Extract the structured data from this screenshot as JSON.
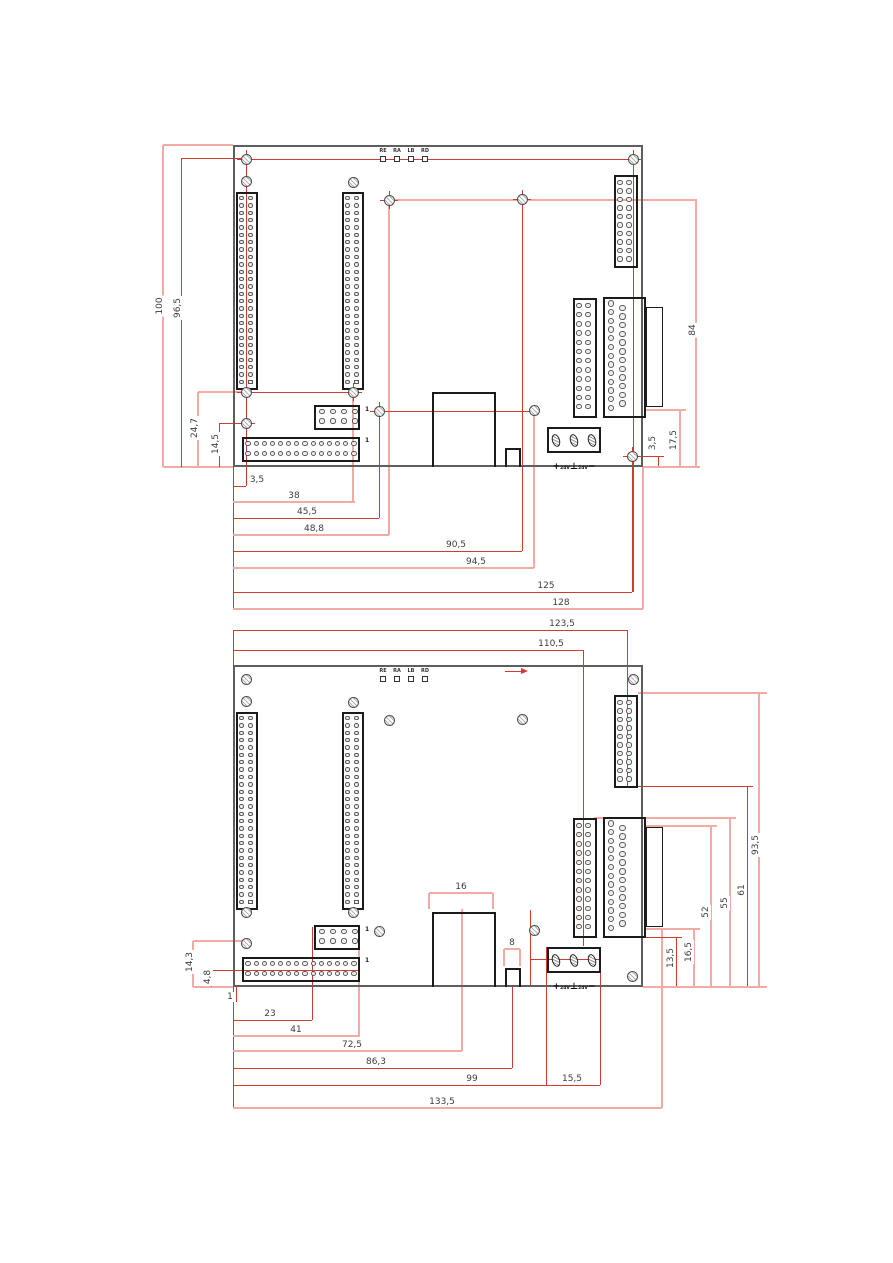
{
  "drawing_type": "pcb-dimension-drawing",
  "colors": {
    "dim_red": "#cf3a31",
    "dim_pink": "#f2aaa5",
    "board_edge": "#5e5e5e",
    "component": "#1b1b1b",
    "text": "#3c3c3c"
  },
  "led_block": {
    "labels": [
      "RE",
      "RA",
      "LB",
      "RD"
    ]
  },
  "power_terminal": {
    "plus": "+",
    "v1": "24V",
    "gnd": "⊥",
    "v2": "24V",
    "minus": "−"
  },
  "pin_one_marker": "1",
  "components": {
    "long_connectors": {
      "positions": [
        [
          3,
          47
        ],
        [
          109,
          47
        ]
      ],
      "w": 22,
      "h": 198,
      "cols": [
        5.5,
        14.5
      ],
      "rows": 26,
      "row_start": 6.2,
      "row_step": 7.35,
      "pin_d": 4.4,
      "square_last": true
    },
    "conn_2x10": {
      "x": 381,
      "y": 30,
      "w": 24,
      "h": 93,
      "cols": [
        6,
        15
      ],
      "rows": 10,
      "row_start": 7.5,
      "row_step": 8.5,
      "pin_d": 5.2
    },
    "conn_2x12": {
      "x": 340,
      "y": 153,
      "w": 24,
      "h": 120,
      "cols": [
        6,
        15
      ],
      "rows": 12,
      "row_start": 7.5,
      "row_step": 9.2,
      "pin_d": 5.6
    },
    "dsub": {
      "x": 370,
      "y": 152,
      "w": 43,
      "h": 121,
      "flange": [
        413,
        162,
        17,
        100
      ],
      "col1_x": 8,
      "col1_n": 13,
      "col2_x": 19.5,
      "col2_n": 12,
      "row_start": 6.5,
      "row_step": 8.7,
      "pin_d": 6.4
    },
    "rj45": {
      "x": 199,
      "y": 247,
      "w": 64,
      "h": 75
    },
    "small_box": {
      "x": 272,
      "y": 303,
      "w": 16,
      "h": 19
    },
    "header_2x4": {
      "x": 81,
      "y": 260,
      "w": 46,
      "h": 25,
      "cols": [
        8,
        19,
        30,
        41
      ],
      "rows_y": [
        6.5,
        16
      ],
      "pin_d": 5.2
    },
    "conn_2x14": {
      "x": 9,
      "y": 292,
      "w": 118,
      "h": 25,
      "n_cols": 14,
      "col_start": 6,
      "col_step": 8.15,
      "rows_y": [
        6.5,
        16.3
      ],
      "pin_d": 5.2
    },
    "power": {
      "x": 314,
      "y": 282,
      "w": 54,
      "h": 26,
      "pins_cx": [
        9,
        27,
        45
      ],
      "pin_cy": 13,
      "pin_w": 8,
      "pin_h": 13,
      "label_y": 27
    },
    "led": {
      "x0": 147,
      "step": 14,
      "sq_y": 11,
      "sq_s": 6,
      "label_y": 3
    },
    "pin1_positions": [
      [
        132,
        261
      ],
      [
        132,
        292
      ]
    ],
    "holes": [
      [
        13,
        14
      ],
      [
        13,
        36
      ],
      [
        120,
        37
      ],
      [
        156,
        55
      ],
      [
        289,
        54
      ],
      [
        400,
        14
      ],
      [
        13,
        247
      ],
      [
        120,
        247
      ],
      [
        146,
        266
      ],
      [
        13,
        278
      ],
      [
        301,
        265
      ],
      [
        399,
        311
      ]
    ],
    "hole_d": 11
  },
  "views": [
    {
      "name": "top-view",
      "board": {
        "x": 233,
        "y": 145,
        "w": 410,
        "h": 322
      },
      "crosshair_holes": [
        0,
        3,
        4,
        5,
        6,
        7,
        8,
        9,
        11
      ],
      "extra_lines": [
        {
          "tone": "red",
          "pts": [
            246,
            159,
            246,
            486
          ]
        },
        {
          "tone": "red",
          "pts": [
            246,
            159,
            633,
            159
          ]
        },
        {
          "tone": "red",
          "pts": [
            633,
            159,
            633,
            592
          ]
        },
        {
          "tone": "red",
          "pts": [
            379,
            411,
            534,
            411
          ]
        },
        {
          "tone": "red",
          "pts": [
            246,
            392,
            353,
            392
          ]
        }
      ],
      "dims": [
        {
          "label": "100",
          "rot": 1,
          "tone": "pink",
          "lx": 160,
          "ly": 306,
          "lines": [
            [
              163,
              145,
              163,
              467
            ],
            [
              163,
              145,
              233,
              145
            ],
            [
              163,
              467,
              233,
              467
            ]
          ]
        },
        {
          "label": "96,5",
          "rot": 1,
          "tone": "red",
          "lx": 178,
          "ly": 308,
          "lines": [
            [
              181,
              158,
              181,
              467
            ],
            [
              181,
              158,
              247,
              158
            ]
          ]
        },
        {
          "label": "24,7",
          "rot": 1,
          "tone": "pink",
          "lx": 195,
          "ly": 428,
          "lines": [
            [
              198,
              392,
              198,
              467
            ],
            [
              198,
              392,
              246,
              392
            ]
          ]
        },
        {
          "label": "14,5",
          "rot": 1,
          "tone": "red",
          "lx": 216,
          "ly": 444,
          "lines": [
            [
              219,
              423,
              219,
              467
            ],
            [
              219,
              423,
              246,
              423
            ]
          ]
        },
        {
          "label": "3,5",
          "rot": 0,
          "tone": "red",
          "lx": 257,
          "ly": 480,
          "lines": [
            [
              233,
              486,
              246,
              486
            ],
            [
              246,
              423,
              246,
              486
            ],
            [
              233,
              467,
              233,
              610
            ]
          ]
        },
        {
          "label": "38",
          "rot": 0,
          "tone": "pink",
          "lx": 294,
          "ly": 496,
          "lines": [
            [
              233,
              502,
              355,
              502
            ],
            [
              353,
              393,
              353,
              502
            ]
          ]
        },
        {
          "label": "45,5",
          "rot": 0,
          "tone": "red",
          "lx": 307,
          "ly": 512,
          "lines": [
            [
              233,
              518,
              379,
              518
            ],
            [
              379,
              411,
              379,
              518
            ]
          ]
        },
        {
          "label": "48,8",
          "rot": 0,
          "tone": "pink",
          "lx": 314,
          "ly": 529,
          "lines": [
            [
              233,
              535,
              389,
              535
            ],
            [
              389,
              200,
              389,
              535
            ]
          ]
        },
        {
          "label": "90,5",
          "rot": 0,
          "tone": "red",
          "lx": 456,
          "ly": 545,
          "lines": [
            [
              233,
              551,
              522,
              551
            ],
            [
              522,
              199,
              522,
              551
            ]
          ]
        },
        {
          "label": "94,5",
          "rot": 0,
          "tone": "pink",
          "lx": 476,
          "ly": 562,
          "lines": [
            [
              233,
              568,
              534,
              568
            ],
            [
              534,
              411,
              534,
              568
            ]
          ]
        },
        {
          "label": "125",
          "rot": 0,
          "tone": "red",
          "lx": 546,
          "ly": 586,
          "lines": [
            [
              233,
              592,
              632,
              592
            ],
            [
              632,
              456,
              632,
              592
            ]
          ]
        },
        {
          "label": "128",
          "rot": 0,
          "tone": "pink",
          "lx": 561,
          "ly": 603,
          "lines": [
            [
              233,
              609,
              643,
              609
            ],
            [
              643,
              467,
              643,
              609
            ]
          ]
        },
        {
          "label": "3,5",
          "rot": 1,
          "tone": "red",
          "lx": 653,
          "ly": 443,
          "lines": [
            [
              658,
              456,
              658,
              467
            ],
            [
              632,
              456,
              664,
              456
            ]
          ]
        },
        {
          "label": "17,5",
          "rot": 1,
          "tone": "pink",
          "lx": 674,
          "ly": 440,
          "lines": [
            [
              680,
              410,
              680,
              467
            ],
            [
              646,
              410,
              686,
              410
            ],
            [
              643,
              467,
              700,
              467
            ]
          ]
        },
        {
          "label": "84",
          "rot": 1,
          "tone": "pink",
          "lx": 693,
          "ly": 330,
          "lines": [
            [
              696,
              199,
              696,
              467
            ],
            [
              389,
              200,
              696,
              200
            ]
          ]
        }
      ]
    },
    {
      "name": "bottom-view",
      "board": {
        "x": 233,
        "y": 665,
        "w": 410,
        "h": 322
      },
      "crosshair_holes": [],
      "arrow": {
        "x1": 505,
        "y1": 671,
        "x2": 521,
        "y2": 671
      },
      "extra_lines": [
        {
          "tone": "red",
          "pts": [
            530,
            910,
            530,
            985
          ]
        },
        {
          "tone": "red",
          "pts": [
            530,
            959,
            600,
            959
          ]
        }
      ],
      "dims": [
        {
          "label": "123,5",
          "rot": 0,
          "tone": "red",
          "lx": 562,
          "ly": 624,
          "lines": [
            [
              233,
              630,
              627,
              630
            ],
            [
              627,
              630,
              627,
              786
            ],
            [
              233,
              630,
              233,
              665
            ]
          ]
        },
        {
          "label": "110,5",
          "rot": 0,
          "tone": "red",
          "lx": 551,
          "ly": 644,
          "lines": [
            [
              233,
              650,
              583,
              650
            ],
            [
              583,
              650,
              583,
              946
            ]
          ]
        },
        {
          "label": "14,3",
          "rot": 1,
          "tone": "pink",
          "lx": 190,
          "ly": 962,
          "lines": [
            [
              193,
              941,
              193,
              987
            ],
            [
              193,
              941,
              243,
              941
            ],
            [
              193,
              987,
              233,
              987
            ]
          ]
        },
        {
          "label": "4,8",
          "rot": 1,
          "tone": "red",
          "lx": 208,
          "ly": 977,
          "lines": [
            [
              211,
              970,
              211,
              987
            ],
            [
              211,
              970,
              360,
              970
            ]
          ]
        },
        {
          "label": "1",
          "rot": 0,
          "tone": "red",
          "lx": 230,
          "ly": 997,
          "lines": [
            [
              236,
              987,
              236,
              1002
            ],
            [
              233,
              987,
              233,
              1108
            ]
          ]
        },
        {
          "label": "23",
          "rot": 0,
          "tone": "red",
          "lx": 270,
          "ly": 1014,
          "lines": [
            [
              233,
              1020,
              312,
              1020
            ],
            [
              312,
              927,
              312,
              1020
            ]
          ]
        },
        {
          "label": "41",
          "rot": 0,
          "tone": "pink",
          "lx": 296,
          "ly": 1030,
          "lines": [
            [
              233,
              1036,
              360,
              1036
            ],
            [
              359,
              950,
              359,
              1036
            ]
          ]
        },
        {
          "label": "72,5",
          "rot": 0,
          "tone": "pink",
          "lx": 352,
          "ly": 1045,
          "lines": [
            [
              233,
              1051,
              462,
              1051
            ],
            [
              462,
              909,
              462,
              1051
            ]
          ]
        },
        {
          "label": "86,3",
          "rot": 0,
          "tone": "red",
          "lx": 376,
          "ly": 1062,
          "lines": [
            [
              233,
              1068,
              512,
              1068
            ],
            [
              512,
              985,
              512,
              1068
            ]
          ]
        },
        {
          "label": "99",
          "rot": 0,
          "tone": "red",
          "lx": 472,
          "ly": 1079,
          "lines": [
            [
              233,
              1085,
              546,
              1085
            ],
            [
              546,
              947,
              546,
              1085
            ]
          ]
        },
        {
          "label": "15,5",
          "rot": 0,
          "tone": "red",
          "lx": 572,
          "ly": 1079,
          "lines": [
            [
              546,
              1085,
              600,
              1085
            ],
            [
              600,
              947,
              600,
              1085
            ]
          ]
        },
        {
          "label": "133,5",
          "rot": 0,
          "tone": "pink",
          "lx": 442,
          "ly": 1102,
          "lines": [
            [
              233,
              1108,
              662,
              1108
            ],
            [
              662,
              929,
              662,
              1108
            ]
          ]
        },
        {
          "label": "16",
          "rot": 0,
          "tone": "pink",
          "lx": 461,
          "ly": 887,
          "lines": [
            [
              429,
              893,
              493,
              893
            ],
            [
              429,
              893,
              429,
              909
            ],
            [
              493,
              893,
              493,
              909
            ]
          ]
        },
        {
          "label": "8",
          "rot": 0,
          "tone": "pink",
          "lx": 512,
          "ly": 943,
          "lines": [
            [
              504,
              949,
              520,
              949
            ],
            [
              504,
              949,
              504,
              966
            ],
            [
              520,
              949,
              520,
              966
            ]
          ]
        },
        {
          "label": "13,5",
          "rot": 1,
          "tone": "red",
          "lx": 671,
          "ly": 958,
          "lines": [
            [
              676,
              937,
              676,
              987
            ],
            [
              640,
              937,
              682,
              937
            ]
          ]
        },
        {
          "label": "16,5",
          "rot": 1,
          "tone": "pink",
          "lx": 689,
          "ly": 952,
          "lines": [
            [
              694,
              929,
              694,
              987
            ],
            [
              644,
              929,
              700,
              929
            ]
          ]
        },
        {
          "label": "52",
          "rot": 1,
          "tone": "pink",
          "lx": 706,
          "ly": 912,
          "lines": [
            [
              711,
              826,
              711,
              987
            ],
            [
              644,
              826,
              717,
              826
            ]
          ]
        },
        {
          "label": "55",
          "rot": 1,
          "tone": "pink",
          "lx": 725,
          "ly": 903,
          "lines": [
            [
              730,
              818,
              730,
              987
            ],
            [
              594,
              818,
              736,
              818
            ]
          ]
        },
        {
          "label": "61",
          "rot": 1,
          "tone": "red",
          "lx": 742,
          "ly": 890,
          "lines": [
            [
              747,
              786,
              747,
              987
            ],
            [
              638,
              786,
              753,
              786
            ]
          ]
        },
        {
          "label": "93,5",
          "rot": 1,
          "tone": "pink",
          "lx": 756,
          "ly": 845,
          "lines": [
            [
              759,
              693,
              759,
              987
            ],
            [
              638,
              693,
              767,
              693
            ],
            [
              643,
              987,
              767,
              987
            ]
          ]
        }
      ]
    }
  ]
}
